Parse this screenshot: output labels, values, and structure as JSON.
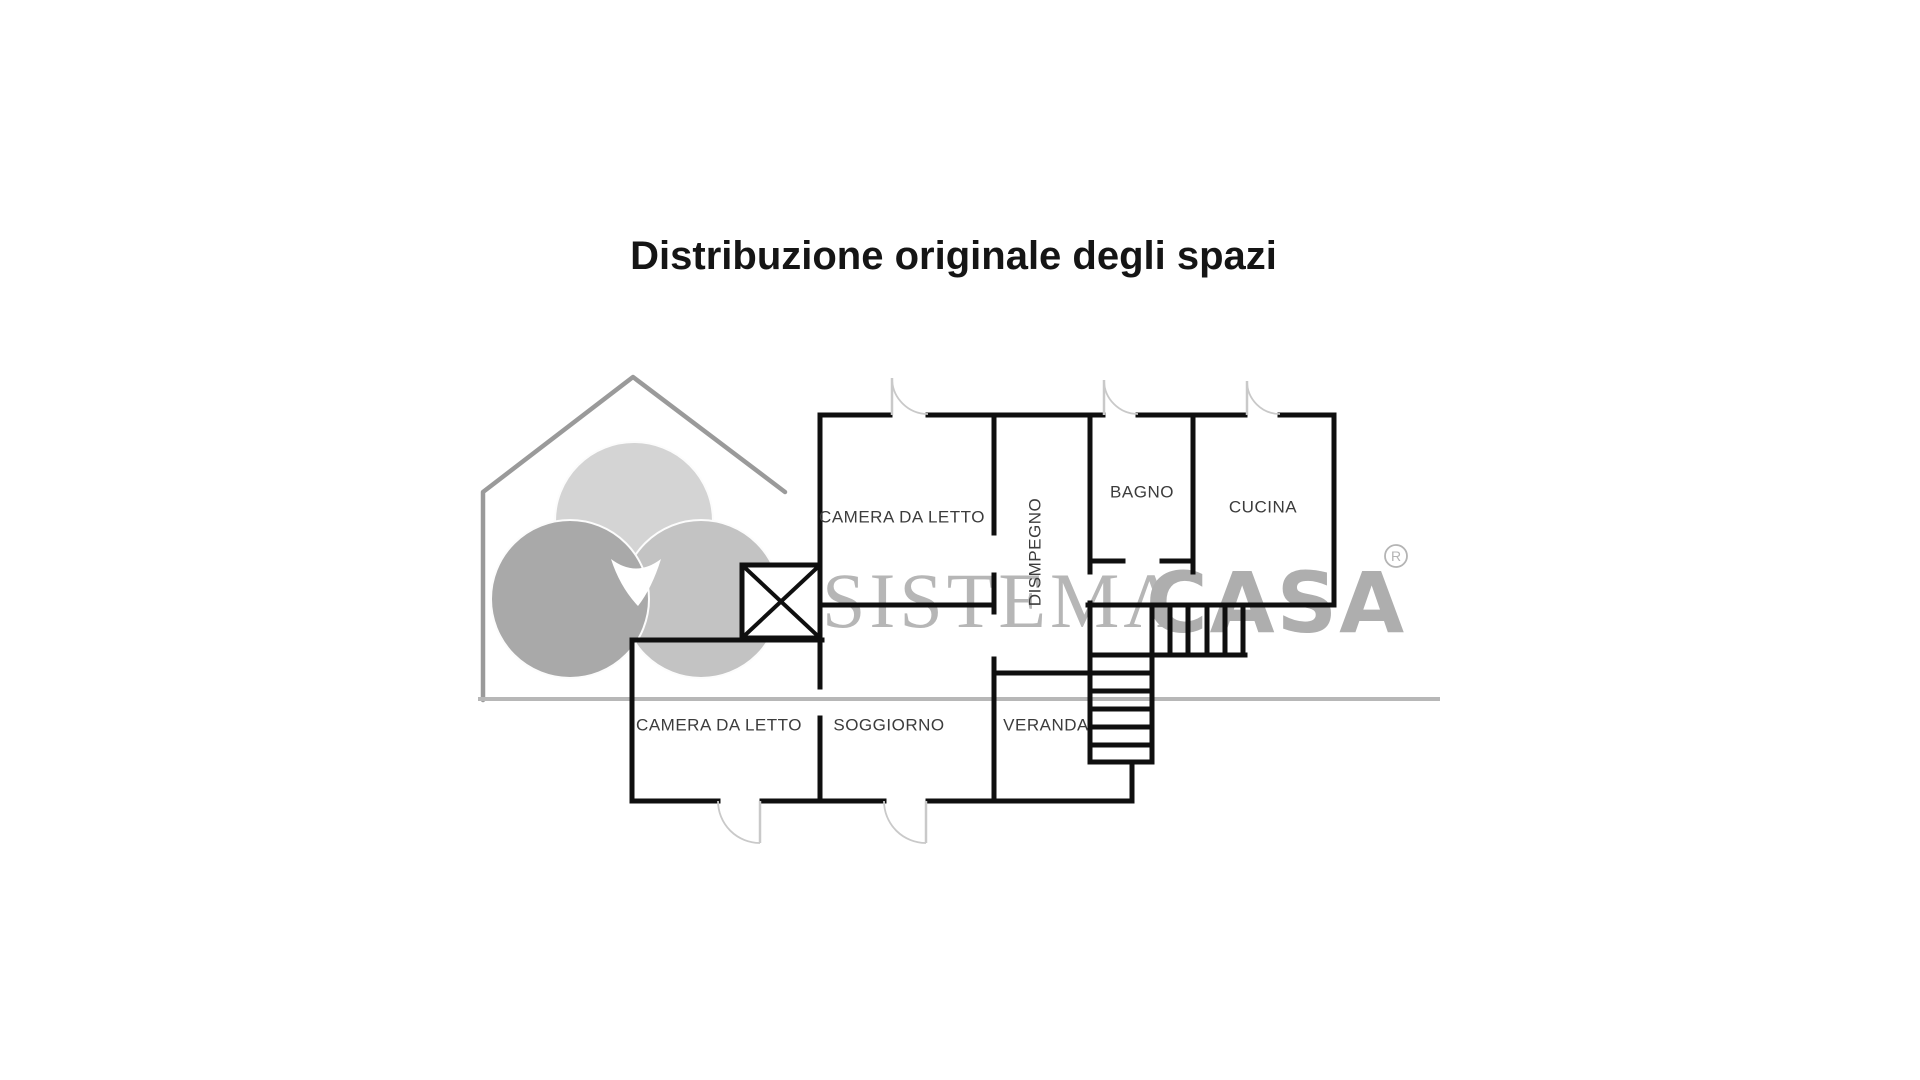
{
  "title": "Distribuzione originale degli spazi",
  "watermark": {
    "brand_serif": "SISTEMΛ",
    "brand_rounded": "CASA",
    "registered_mark": "R",
    "house_color": "#9a9a9a",
    "baseline_color": "#b7b7b7",
    "serif_text_color": "#b6b6b6",
    "rounded_text_color": "#aeaeae",
    "house_points": "483,700 483,492 633,377 785,492",
    "baseline": [
      478,
      699,
      1440,
      699
    ],
    "circles": [
      {
        "cx": 634,
        "cy": 521,
        "r": 79,
        "fill": "#d4d4d4"
      },
      {
        "cx": 701,
        "cy": 599,
        "r": 79,
        "fill": "#c3c3c3"
      },
      {
        "cx": 570,
        "cy": 599,
        "r": 79,
        "fill": "#a9a9a9"
      }
    ],
    "center_gap_path": "M611,559 Q636,578 661,559 Q652,588 638,606 Q620,587 611,559 Z",
    "serif_pos": [
      822,
      627
    ],
    "rounded_pos": [
      1146,
      632
    ],
    "reg_circle": [
      1396,
      556,
      11
    ]
  },
  "plan": {
    "wall_color": "#0f0f0f",
    "wall_width": 5,
    "door_color": "#c9c9c9",
    "door_width": 2.5,
    "walls": [
      [
        820,
        415,
        890,
        415
      ],
      [
        928,
        415,
        1103,
        415
      ],
      [
        1138,
        415,
        1245,
        415
      ],
      [
        1280,
        415,
        1334,
        415
      ],
      [
        1090,
        561,
        1123,
        561
      ],
      [
        1162,
        561,
        1193,
        561
      ],
      [
        818,
        605,
        994,
        605
      ],
      [
        1088,
        605,
        1334,
        605
      ],
      [
        632,
        640,
        822,
        640
      ],
      [
        994,
        673,
        1092,
        673
      ],
      [
        1152,
        655,
        1245,
        655
      ],
      [
        1090,
        762,
        1152,
        762
      ],
      [
        632,
        801,
        718,
        801
      ],
      [
        762,
        801,
        884,
        801
      ],
      [
        928,
        801,
        1132,
        801
      ],
      [
        1090,
        655,
        1152,
        655
      ],
      [
        1090,
        673,
        1152,
        673
      ],
      [
        1090,
        691,
        1152,
        691
      ],
      [
        1090,
        709,
        1152,
        709
      ],
      [
        1090,
        727,
        1152,
        727
      ],
      [
        1090,
        745,
        1152,
        745
      ],
      [
        820,
        415,
        820,
        687
      ],
      [
        820,
        718,
        820,
        801
      ],
      [
        632,
        640,
        632,
        801
      ],
      [
        994,
        415,
        994,
        533
      ],
      [
        994,
        575,
        994,
        612
      ],
      [
        994,
        659,
        994,
        801
      ],
      [
        1090,
        415,
        1090,
        572
      ],
      [
        1090,
        603,
        1090,
        762
      ],
      [
        1193,
        415,
        1193,
        572
      ],
      [
        1334,
        415,
        1334,
        605
      ],
      [
        1132,
        762,
        1132,
        801
      ],
      [
        1152,
        605,
        1152,
        762
      ],
      [
        1170,
        605,
        1170,
        655
      ],
      [
        1188,
        605,
        1188,
        655
      ],
      [
        1207,
        605,
        1207,
        655
      ],
      [
        1225,
        605,
        1225,
        655
      ],
      [
        1243,
        605,
        1243,
        655
      ]
    ],
    "flue_box": {
      "x": 742,
      "y": 565,
      "w": 78,
      "h": 73
    },
    "door_leaves": [
      [
        892,
        378,
        892,
        415
      ],
      [
        1104,
        380,
        1104,
        415
      ],
      [
        1247,
        381,
        1247,
        415
      ],
      [
        760,
        801,
        760,
        843
      ],
      [
        926,
        801,
        926,
        843
      ]
    ],
    "door_arcs": [
      "M892,378 A36,36 0 0 0 928,414",
      "M1104,380 A34,34 0 0 0 1138,414",
      "M1247,381 A33,33 0 0 0 1280,414",
      "M718,801 A42,42 0 0 0 760,843",
      "M884,801 A42,42 0 0 0 926,843"
    ]
  },
  "rooms": [
    {
      "label": "CAMERA DA LETTO",
      "x": 902,
      "y": 518,
      "rotate": 0
    },
    {
      "label": "DISMPEGNO",
      "x": 1036,
      "y": 552,
      "rotate": -90
    },
    {
      "label": "BAGNO",
      "x": 1142,
      "y": 493,
      "rotate": 0
    },
    {
      "label": "CUCINA",
      "x": 1263,
      "y": 508,
      "rotate": 0
    },
    {
      "label": "CAMERA DA LETTO",
      "x": 719,
      "y": 726,
      "rotate": 0
    },
    {
      "label": "SOGGIORNO",
      "x": 889,
      "y": 726,
      "rotate": 0
    },
    {
      "label": "VERANDA",
      "x": 1046,
      "y": 726,
      "rotate": 0
    }
  ]
}
